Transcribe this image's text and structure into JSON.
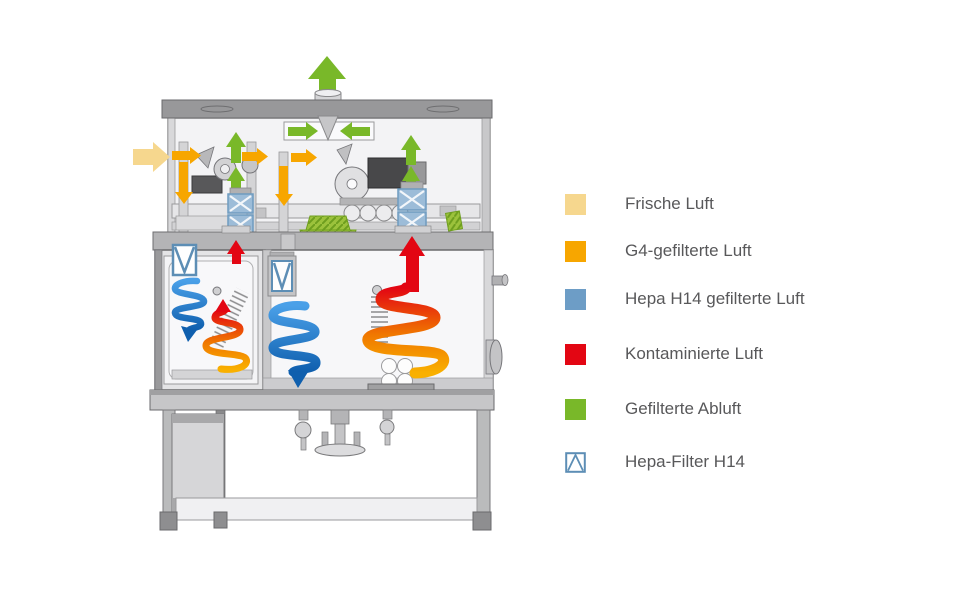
{
  "legend": {
    "items": [
      {
        "label": "Frische Luft",
        "color": "#F6D78E",
        "symbol": "square"
      },
      {
        "label": "G4-gefilterte Luft",
        "color": "#F7A600",
        "symbol": "square"
      },
      {
        "label": "Hepa H14 gefilterte Luft",
        "color": "#6D9DC6",
        "symbol": "square"
      },
      {
        "label": "Kontaminierte Luft",
        "color": "#E30613",
        "symbol": "square"
      },
      {
        "label": "Gefilterte Abluft",
        "color": "#79B829",
        "symbol": "square"
      },
      {
        "label": "Hepa-Filter H14",
        "color": "#5D8EB5",
        "symbol": "hepa-filter"
      }
    ]
  },
  "colors": {
    "fresh_air": "#F6D78E",
    "g4_air": "#F7A600",
    "hepa_air": "#6D9DC6",
    "contaminated_air": "#E30613",
    "exhaust_air": "#79B829",
    "hepa_filter_frame": "#5D8EB5",
    "text": "#58585A"
  },
  "diagram": {
    "machine": "isolator airflow schematic",
    "arrows": [
      {
        "name": "exhaust-top",
        "direction": "up",
        "color_key": "exhaust_air"
      },
      {
        "name": "collector-left",
        "direction": "right",
        "color_key": "exhaust_air"
      },
      {
        "name": "collector-right",
        "direction": "left",
        "color_key": "exhaust_air"
      },
      {
        "name": "fresh-air-inlet",
        "direction": "right",
        "color_key": "fresh_air"
      },
      {
        "name": "g4-inlet-left",
        "direction": "right",
        "color_key": "g4_air"
      },
      {
        "name": "g4-down-left",
        "direction": "down",
        "color_key": "g4_air"
      },
      {
        "name": "g4-inlet-mid",
        "direction": "right",
        "color_key": "g4_air"
      },
      {
        "name": "g4-inlet-mid2",
        "direction": "right",
        "color_key": "g4_air"
      },
      {
        "name": "g4-down-mid",
        "direction": "down",
        "color_key": "g4_air"
      },
      {
        "name": "filtered-up-left-tall",
        "direction": "up",
        "color_key": "exhaust_air"
      },
      {
        "name": "filtered-up-left-short",
        "direction": "up",
        "color_key": "exhaust_air"
      },
      {
        "name": "filtered-up-right-tall",
        "direction": "up",
        "color_key": "exhaust_air"
      },
      {
        "name": "filtered-up-right-short",
        "direction": "up",
        "color_key": "exhaust_air"
      },
      {
        "name": "contaminated-up-left",
        "direction": "up",
        "color_key": "contaminated_air"
      },
      {
        "name": "contaminated-up-right",
        "direction": "up",
        "color_key": "contaminated_air"
      }
    ],
    "filters": [
      "hepa-stack-left",
      "hepa-stack-right",
      "hepa-panel-left-chamber",
      "hepa-panel-main-chamber"
    ],
    "airflow_spirals": [
      {
        "name": "clean-air-spiral-left-chamber",
        "color": "blue",
        "direction": "down"
      },
      {
        "name": "contaminated-spiral-left-chamber",
        "color": "orange-red",
        "direction": "up"
      },
      {
        "name": "clean-air-spiral-main-chamber",
        "color": "blue",
        "direction": "down"
      },
      {
        "name": "contaminated-spiral-main-chamber",
        "color": "orange-red",
        "direction": "up"
      }
    ]
  }
}
